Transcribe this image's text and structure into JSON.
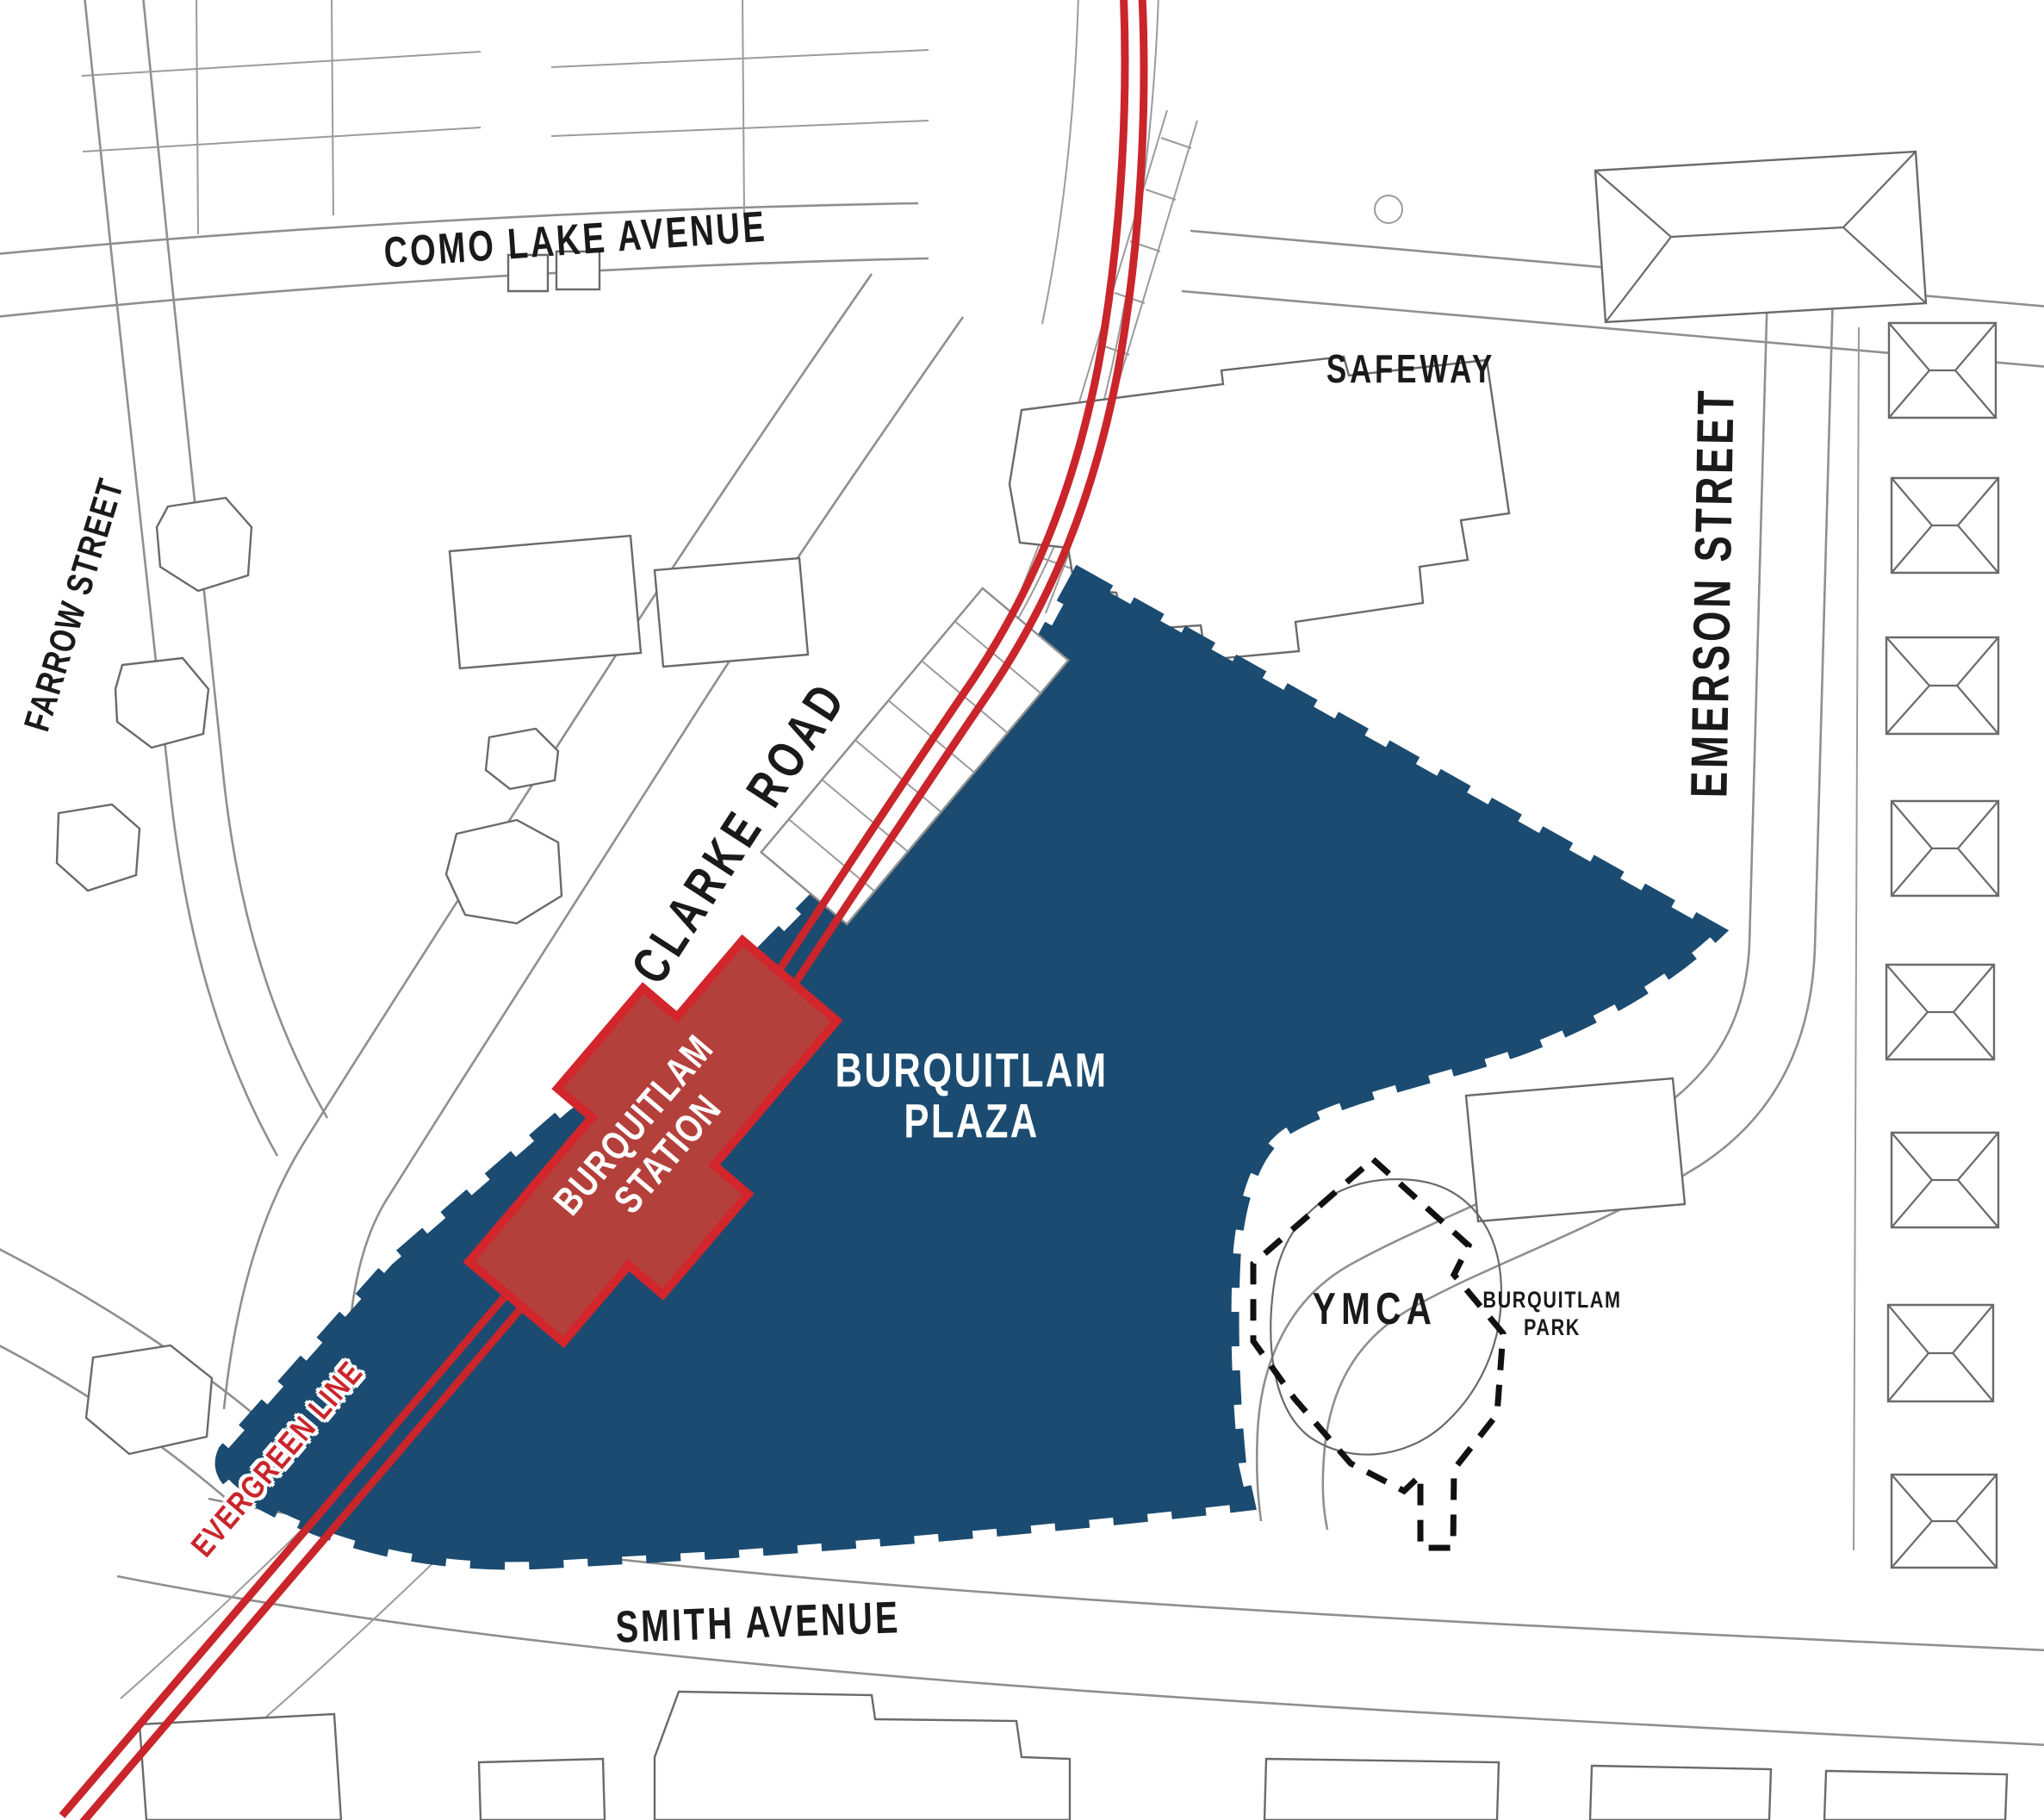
{
  "map": {
    "labels": {
      "como_lake_avenue": "COMO LAKE AVENUE",
      "farrow_street": "FARROW STREET",
      "clarke_road": "CLARKE ROAD",
      "safeway": "SAFEWAY",
      "emerson_street": "EMERSON STREET",
      "smith_avenue": "SMITH AVENUE",
      "plaza_line1": "BURQUITLAM",
      "plaza_line2": "PLAZA",
      "station_line1": "BURQUITLAM",
      "station_line2": "STATION",
      "evergreen_line": "EVERGREEN LINE",
      "ymca": "YMCA",
      "park_line1": "BURQUITLAM",
      "park_line2": "PARK"
    },
    "colors": {
      "site_blue": "#1b4b70",
      "transit_red": "#c9252b",
      "station_fill": "#b4403b",
      "station_border": "#d2252c",
      "label_black": "#1a1a1a",
      "linework_gray": "#8f8f8f",
      "background": "#ffffff"
    }
  }
}
